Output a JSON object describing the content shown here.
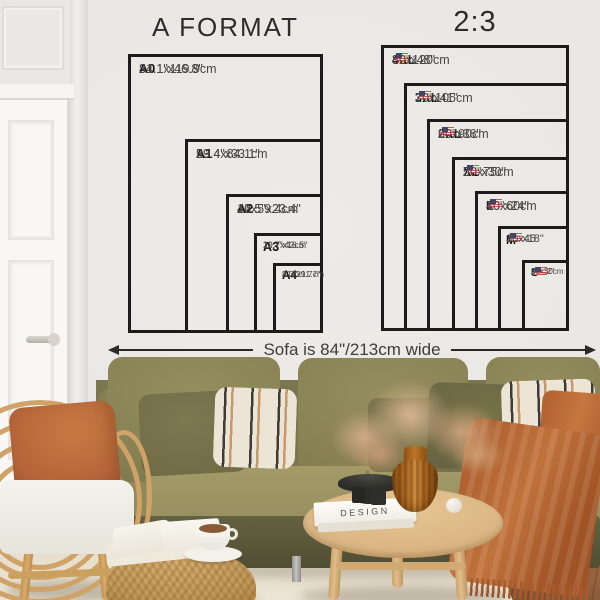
{
  "charts": [
    {
      "title": "A FORMAT",
      "sizes": [
        {
          "label": "A0",
          "in": "31.1\"x46.8\"",
          "cm": "84.1x119.9cm"
        },
        {
          "label": "A1",
          "in": "23.4\"x33.1\"",
          "cm": "59.4x84.1cm"
        },
        {
          "label": "A2",
          "in": "16.5\"x23.4\"",
          "cm": "42x59.4cm"
        },
        {
          "label": "A3",
          "in": "11.7\"x16.5\"",
          "cm": "29.7x42cm"
        },
        {
          "label": "A4",
          "in": "8.3\"x11.7\"",
          "cm": "21x29.7cm"
        }
      ]
    },
    {
      "title": "2:3",
      "sizes": [
        {
          "label": "4XL",
          "in": "32\"x48\"",
          "cm": "80x120cm"
        },
        {
          "label": "3XL",
          "in": "27\"x41\"",
          "cm": "70x105cm"
        },
        {
          "label": "2XL",
          "in": "24\"x36\"",
          "cm": "60x90cm"
        },
        {
          "label": "XL",
          "in": "20\"x30\"",
          "cm": "50x75cm"
        },
        {
          "label": "L",
          "in": "16\"x24\"",
          "cm": "40x60cm"
        },
        {
          "label": "M",
          "in": "12\"x18\"",
          "cm": "30x45"
        },
        {
          "label": "S",
          "in": "8\"x12\"",
          "cm": "20x30cm"
        }
      ]
    }
  ],
  "sofa_note": "Sofa is 84\"/213cm wide",
  "book_title": "DESIGN",
  "icons": {
    "us_flag": "us-flag-icon",
    "width_arrow": "double-headed-arrow"
  },
  "colors": {
    "line": "#1b1b1b",
    "wall": "#eceae6",
    "sofa_green": "#8d8757",
    "rust": "#b5663a",
    "rattan": "#cfa268",
    "wood": "#d9b583"
  }
}
